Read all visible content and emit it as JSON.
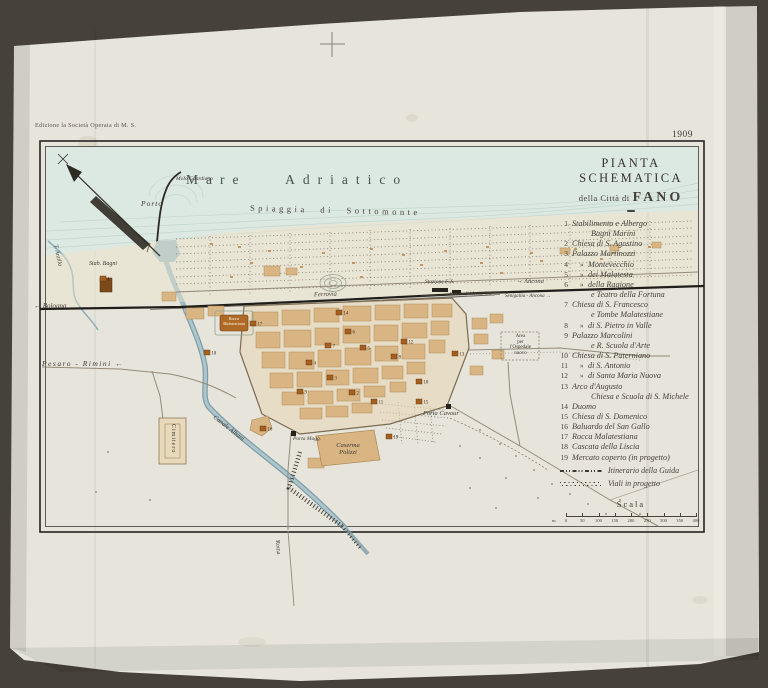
{
  "photo": {
    "edition_note": "Edizione la Società Operaia di M. S.",
    "year_stamp": "1909"
  },
  "title_block": {
    "line1": "PIANTA SCHEMATICA",
    "line2_small": "della Città di",
    "line2_big": "FANO"
  },
  "legend": {
    "ditto_mark": "»",
    "items": [
      {
        "n": "1",
        "text": "Stabilimento e Albergo",
        "sub": "Bagni Marini"
      },
      {
        "n": "2",
        "text": "Chiesa di S. Agostino"
      },
      {
        "n": "3",
        "text": "Palazzo Martinozzi"
      },
      {
        "n": "4",
        "ditto": true,
        "text": "Montevecchio"
      },
      {
        "n": "5",
        "ditto": true,
        "text": "dei Malatesta"
      },
      {
        "n": "6",
        "ditto": true,
        "text": "della Ragione",
        "sub": "e Teatro della Fortuna"
      },
      {
        "n": "7",
        "text": "Chiesa di S. Francesco",
        "sub": "e Tombe Malatestiane"
      },
      {
        "n": "8",
        "ditto": true,
        "text": "di S. Pietro in Valle"
      },
      {
        "n": "9",
        "text": "Palazzo Marcolini",
        "sub": "e R. Scuola d'Arte"
      },
      {
        "n": "10",
        "text": "Chiesa di S. Paterniano"
      },
      {
        "n": "11",
        "ditto": true,
        "text": "di S. Antonio"
      },
      {
        "n": "12",
        "ditto": true,
        "text": "di Santa Maria Nuova"
      },
      {
        "n": "13",
        "text": "Arco d'Augusto",
        "sub": "Chiesa e Scuola di S. Michele"
      },
      {
        "n": "14",
        "text": "Duomo"
      },
      {
        "n": "15",
        "text": "Chiesa di S. Domenico"
      },
      {
        "n": "16",
        "text": "Baluardo del San Gallo"
      },
      {
        "n": "17",
        "text": "Rocca Malatestiana"
      },
      {
        "n": "18",
        "text": "Cascata della Liscia"
      },
      {
        "n": "19",
        "text": "Mercato coperto (in progetto)"
      }
    ],
    "symbols": [
      {
        "label": "Itinerario della Guida"
      },
      {
        "label": "Viali in progetto"
      }
    ]
  },
  "scale": {
    "title": "Scala",
    "unit": "m.",
    "ticks": [
      "0",
      "50",
      "100",
      "150",
      "200",
      "250",
      "300",
      "350",
      "400"
    ]
  },
  "labels": {
    "sea": "Mare Adriatico",
    "beach": "Spiaggia di Sottomonte",
    "molo": "Molo Guardiano",
    "porto": "Porto",
    "stab_bagni": "Stab. Bagni",
    "arzilla": "T. Arzilla",
    "bologna": "Bologna",
    "pesaro_rimini": "Pesaro - Rimini",
    "ferrovia": "Ferrovia",
    "stazione": "Stazione F. S.",
    "ancona": "Ancona",
    "metaurilia": "Strada di Metaurilia",
    "senigallia": "Senigallia - Ancona",
    "porta_cavour": "Porta Cavour",
    "porta_maggiore": "Porta Magg.",
    "caserma_line1": "Caserma",
    "caserma_line2": "Polizzi",
    "canale": "Canale Albani",
    "cimitero": "Cimitero",
    "ospedale": [
      "Area",
      "per",
      "l'Ospedale",
      "nuovo"
    ],
    "roma": "Roma",
    "rocca_line1": "Rocca",
    "rocca_line2": "Malatestiana"
  },
  "icons": {
    "arrow_left": "←",
    "arrow_right": "→"
  },
  "map_markers": [
    {
      "n": "1",
      "x": 100,
      "y": 276
    },
    {
      "n": "2",
      "x": 349,
      "y": 390
    },
    {
      "n": "3",
      "x": 327,
      "y": 375
    },
    {
      "n": "4",
      "x": 306,
      "y": 360
    },
    {
      "n": "5",
      "x": 360,
      "y": 345
    },
    {
      "n": "6",
      "x": 345,
      "y": 329
    },
    {
      "n": "7",
      "x": 325,
      "y": 343
    },
    {
      "n": "8",
      "x": 391,
      "y": 354
    },
    {
      "n": "9",
      "x": 297,
      "y": 389
    },
    {
      "n": "10",
      "x": 416,
      "y": 379
    },
    {
      "n": "11",
      "x": 371,
      "y": 399
    },
    {
      "n": "12",
      "x": 401,
      "y": 339
    },
    {
      "n": "13",
      "x": 452,
      "y": 351
    },
    {
      "n": "14",
      "x": 336,
      "y": 310
    },
    {
      "n": "15",
      "x": 416,
      "y": 399
    },
    {
      "n": "16",
      "x": 260,
      "y": 426
    },
    {
      "n": "17",
      "x": 250,
      "y": 321
    },
    {
      "n": "18",
      "x": 204,
      "y": 350
    },
    {
      "n": "19",
      "x": 386,
      "y": 434
    }
  ],
  "colors": {
    "backdrop": "#46423a",
    "paper": "#e7e5db",
    "sea": "#dce8e2",
    "water": "#9fbac3",
    "block": "#d9b584",
    "ink": "#2e2a24"
  }
}
